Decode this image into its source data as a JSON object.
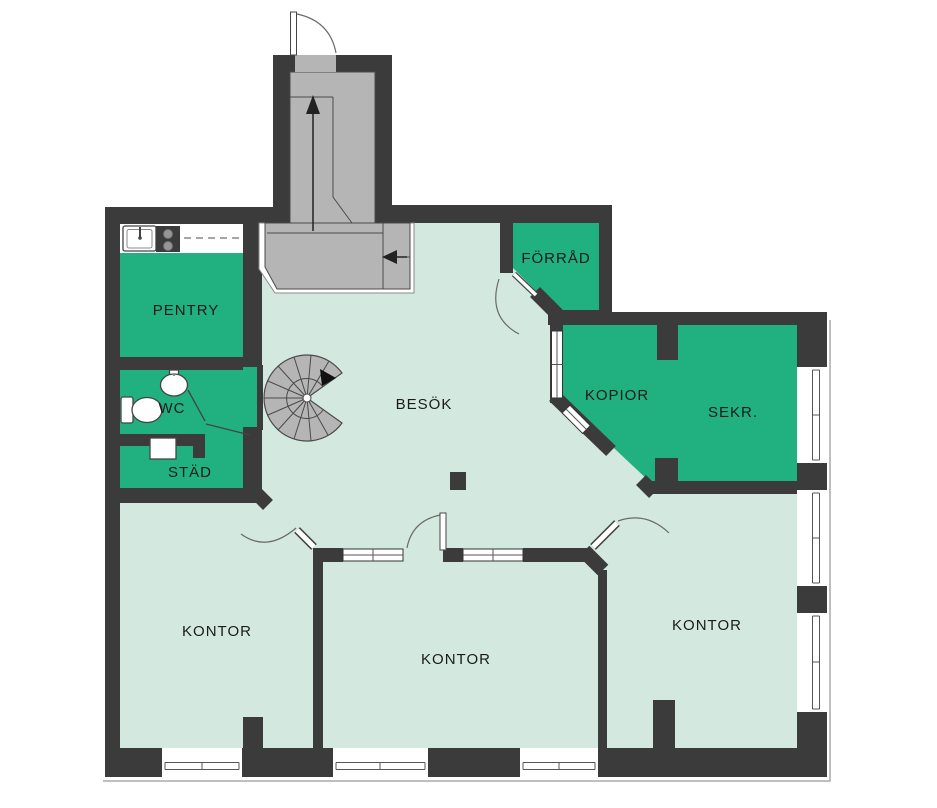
{
  "floorplan": {
    "type": "office-floor-plan",
    "rooms": {
      "pentry": {
        "label": "PENTRY"
      },
      "wc": {
        "label": "WC"
      },
      "stad": {
        "label": "STÄD"
      },
      "besok": {
        "label": "BESÖK"
      },
      "forrad": {
        "label": "FÖRRÅD"
      },
      "kopior": {
        "label": "KOPIOR"
      },
      "sekr": {
        "label": "SEKR."
      },
      "kontor_left": {
        "label": "KONTOR"
      },
      "kontor_middle": {
        "label": "KONTOR"
      },
      "kontor_right": {
        "label": "KONTOR"
      }
    },
    "colors": {
      "wall": "#3b3b3b",
      "room_highlight_green": "#21b181",
      "floor_mint": "#d3e9df",
      "stairs_gray": "#b5b5b5",
      "outline_gray": "#aaaaaa",
      "background": "#ffffff"
    },
    "fixtures": [
      "kitchen-counter",
      "kitchen-sink",
      "stove",
      "wash-basin",
      "toilet",
      "cleaning-sink",
      "spiral-staircase",
      "staircase",
      "up-arrow-icon",
      "left-arrow-icon",
      "column",
      "window",
      "door-swing"
    ]
  }
}
